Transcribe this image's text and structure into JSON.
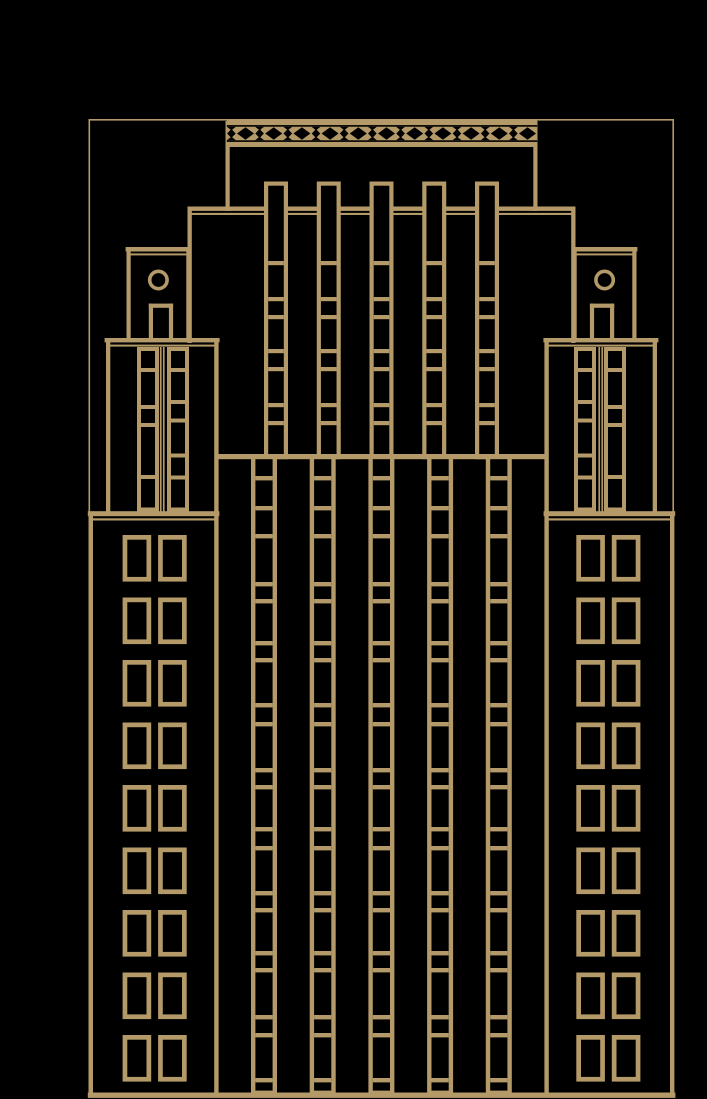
{
  "page": {
    "title": "Art deco skyscraper line illustration",
    "colors": {
      "bg": "#000000",
      "line": "#b39a68"
    }
  },
  "illustration": {
    "canvas": {
      "w": 707,
      "h": 1099
    },
    "mirror_x": 381.5,
    "outer_frame": {
      "x": 89.3,
      "y": 119.8,
      "w": 583.9,
      "h": 975.7,
      "stroke": 1.6
    },
    "ground": {
      "x": 87.8,
      "y": 1092.5,
      "w": 587.6,
      "h": 5.4
    },
    "pavilion": {
      "walls": [
        {
          "x": 225.5,
          "y": 121,
          "w": 4.2,
          "h": 90
        },
        {
          "x": 533.3,
          "y": 121,
          "w": 4.2,
          "h": 90
        }
      ],
      "lattice": {
        "x": 226.8,
        "y": 120.4,
        "w": 310.4,
        "h": 26.6,
        "slit_h": 1.6,
        "slit1_y": 125.1,
        "slit2_y": 140.3,
        "cy": 133.5,
        "field_top": 126.7,
        "field_bottom": 140.3,
        "pitch": 28.2,
        "count": 11,
        "big_start_cx": 245.5,
        "big_w": 17,
        "big_h": 12.4,
        "small_start_cx": 231.4,
        "small_w": 8.6,
        "small_h": 9,
        "notch_w": 9,
        "notch_h": 3.6
      }
    },
    "upper_tier": {
      "ledge": {
        "x": 187.5,
        "w": 388,
        "thick_y": 206.5,
        "thick_h": 4.4,
        "thin_y": 212.9,
        "thin_h": 2.1
      },
      "walls": [
        {
          "x": 187.5,
          "y": 206.5,
          "w": 4.3,
          "h": 136.5
        },
        {
          "x": 571.2,
          "y": 206.5,
          "w": 4.3,
          "h": 136.5
        }
      ],
      "columns": {
        "centers": [
          276,
          328.75,
          381.5,
          434.25,
          487
        ],
        "w": 24,
        "stroke": 4.2,
        "top": 181.5,
        "bottom": 459.2,
        "rungs": [
          261,
          297,
          315,
          349,
          367,
          403,
          421
        ]
      }
    },
    "shoulder": {
      "x": 216.6,
      "y": 454,
      "w": 329.8,
      "h": 5.2
    },
    "facade_strips": {
      "lefts": [
        251,
        309.7,
        368.4,
        427.1,
        485.8
      ],
      "w": 26,
      "stroke": 4.4,
      "top": 454,
      "bottom": 1095,
      "rungs": [
        476,
        506,
        534,
        582,
        599,
        641,
        658,
        703,
        722,
        768,
        785,
        827,
        846,
        891,
        908,
        951,
        968,
        1015,
        1033,
        1078
      ]
    },
    "side": {
      "box": {
        "wall_l_x": 126.5,
        "wall_r_x": 186.3,
        "wall_w": 4.2,
        "wall_top": 247.5,
        "bottom": 338.5,
        "cap_x": 125.6,
        "cap_y": 247,
        "cap_w": 65.8,
        "cap_h": 4.5,
        "thin_x": 126.5,
        "thin_y": 253.4,
        "thin_w": 64,
        "thin_h": 2,
        "circle": {
          "cx": 158.4,
          "cy": 280,
          "r": 8.7,
          "stroke": 3.6
        },
        "door": {
          "x": 148.8,
          "w": 24.3,
          "side_w": 4.2,
          "top_y": 303.6,
          "top_h": 4.2,
          "bottom": 338.6
        }
      },
      "tower": {
        "wall_l": {
          "x": 106,
          "y": 342,
          "w": 4.3,
          "h": 169.5
        },
        "wall_r": {
          "x": 214.2,
          "y": 342,
          "w": 4.4,
          "h": 753.5
        },
        "ledge": {
          "thick_x": 104.6,
          "thick_y": 338,
          "thick_w": 115,
          "thick_h": 4.4,
          "thin_x": 106.5,
          "thin_y": 344.6,
          "thin_w": 111,
          "thin_h": 2
        },
        "strip_top": 347,
        "strip_bottom": 511.5,
        "strips": [
          {
            "x": 137,
            "w": 22,
            "stroke": 4,
            "rungs": [
              368,
              405,
              423,
              475
            ]
          },
          {
            "x": 167,
            "w": 22,
            "stroke": 4,
            "rungs": [
              368,
              400,
              418.5,
              453.5,
              475.5
            ]
          }
        ],
        "mullions": [
          {
            "x": 159.9,
            "w": 1.7
          },
          {
            "x": 162.9,
            "w": 1.7
          }
        ]
      },
      "wing": {
        "ledge": {
          "thick_x": 87.8,
          "thick_y": 511.2,
          "thick_w": 131.6,
          "thick_h": 5,
          "thin_x": 89.5,
          "thin_y": 518.3,
          "thin_w": 128,
          "thin_h": 2.2
        },
        "wall": {
          "x": 88.6,
          "y": 514,
          "w": 4.4,
          "h": 581.5
        },
        "windows": {
          "cols": [
            122.6,
            158.1
          ],
          "w": 28.6,
          "h": 46.6,
          "stroke": 4.7,
          "row_tops": [
            535,
            597.5,
            660,
            722.5,
            785,
            847.5,
            910,
            972.5,
            1035
          ]
        }
      }
    }
  }
}
